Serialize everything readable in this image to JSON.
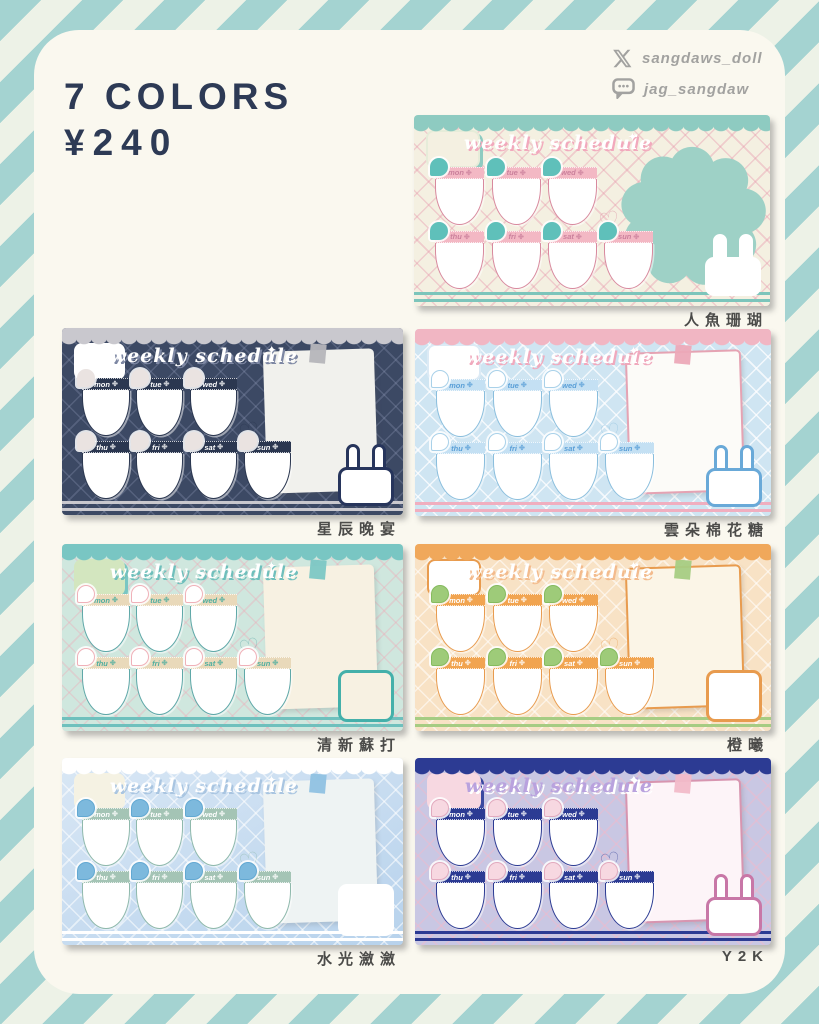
{
  "page": {
    "title": "7 COLORS",
    "price": "¥240",
    "socials": [
      {
        "icon": "x-icon",
        "handle": "sangdaws_doll"
      },
      {
        "icon": "chat-bubble-icon",
        "handle": "jag_sangdaw"
      }
    ],
    "colors": {
      "stripe_teal": "#a4d3d1",
      "stripe_cream": "#edf2e7",
      "panel_bg": "#faf8ef",
      "title_color": "#2d3a55",
      "social_color": "#a2a2a0",
      "label_color": "#4b4b49"
    }
  },
  "card_common": {
    "title": "weekly schedule",
    "days_row1": [
      "mon",
      "tue",
      "wed"
    ],
    "days_row2": [
      "thu",
      "fri",
      "sat",
      "sun"
    ],
    "clover_icon": "✤",
    "sparkle_icon": "✦",
    "heart_icon": "♡"
  },
  "cards": [
    {
      "label": "人魚珊瑚",
      "right_variant": "blob",
      "corner_variant": "bunny",
      "vars": {
        "--bg": "#f4f0e1",
        "--lattice": "rgba(231,151,172,0.40)",
        "--scallop": "#8ecbc1",
        "--title": "#ffffff",
        "--title-shadow": "#f2a9bd",
        "--head-bg": "#f3b8c4",
        "--head-text": "#cb809c",
        "--drop": "#5fc0ba",
        "--drop-border": "#5fc0ba",
        "--pocket-border": "#d8899e",
        "--paper-bg": "#f4f0e1",
        "--paper-border": "#f4f0e1",
        "--tape": "#8ecbc1",
        "--blob": "#9ed1c6",
        "--corner-bg": "#ffffff",
        "--corner-border": "#ffffff",
        "--stripe": "#7cc5bb",
        "--note-bg": "#f4f0e1",
        "--note-border": "#e6ecd9",
        "--note-shadow": "#8ecbc1"
      }
    },
    {
      "label": "星辰晚宴",
      "right_variant": "paper",
      "corner_variant": "bunny",
      "vars": {
        "--bg": "#3c4964",
        "--lattice": "rgba(150,160,190,0.28)",
        "--scallop": "#c9c8ce",
        "--title": "#ffffff",
        "--title-shadow": "#7d87a3",
        "--head-bg": "#2b3750",
        "--head-text": "#ffffff",
        "--drop": "#eae3e1",
        "--drop-border": "#eae3e1",
        "--pocket-border": "#2b3750",
        "--paper-bg": "#f1f1ed",
        "--paper-border": "#f1f1ed",
        "--tape": "#b5b5ba",
        "--blob": "#c9c8ce",
        "--corner-bg": "#ffffff",
        "--corner-border": "#27355c",
        "--stripe": "#c9c8ce",
        "--note-bg": "#ffffff",
        "--note-border": "#ffffff",
        "--note-shadow": "rgba(0,0,0,0)"
      }
    },
    {
      "label": "雲朵棉花糖",
      "right_variant": "paper",
      "corner_variant": "bunny",
      "vars": {
        "--bg": "#cfe5f2",
        "--lattice": "rgba(255,255,255,0.75)",
        "--scallop": "#f1b6c3",
        "--title": "#ffffff",
        "--title-shadow": "#f0a9bd",
        "--head-bg": "#c4e0f3",
        "--head-text": "#5a9fd7",
        "--drop": "#ffffff",
        "--drop-border": "#a9d1e9",
        "--pocket-border": "#8abedd",
        "--paper-bg": "#fcfbf8",
        "--paper-border": "#e5a3b3",
        "--tape": "#eca9b8",
        "--blob": "#f1b6c3",
        "--corner-bg": "#ffffff",
        "--corner-border": "#69a9d8",
        "--stripe": "#f0aebf",
        "--note-bg": "#ffffff",
        "--note-border": "#dceaf5",
        "--note-shadow": "rgba(0,0,0,0)"
      }
    },
    {
      "label": "清新蘇打",
      "right_variant": "paper",
      "corner_variant": "square",
      "vars": {
        "--bg": "#cfe7de",
        "--lattice": "rgba(240,165,180,0.35)",
        "--scallop": "#79c6c3",
        "--title": "#ffffff",
        "--title-shadow": "#6fbfbc",
        "--head-bg": "#e9d9ba",
        "--head-text": "#4fae9f",
        "--drop": "#ffffff",
        "--drop-border": "#f0b1b9",
        "--pocket-border": "#5fa8a8",
        "--paper-bg": "#f7f1e2",
        "--paper-border": "#f7f1e2",
        "--tape": "#7cc7c4",
        "--blob": "#79c6c3",
        "--corner-bg": "#f7f1e2",
        "--corner-border": "#44b0aa",
        "--stripe": "#6fc0bd",
        "--note-bg": "#d3e6bf",
        "--note-border": "#d3e6bf",
        "--note-shadow": "#79c6c3"
      }
    },
    {
      "label": "橙曦",
      "right_variant": "paper",
      "corner_variant": "square",
      "vars": {
        "--bg": "#f8e2c5",
        "--lattice": "rgba(255,255,255,0.55)",
        "--scallop": "#f0a85b",
        "--title": "#ffffff",
        "--title-shadow": "#f3bb8d",
        "--head-bg": "#f1a450",
        "--head-text": "#ffffff",
        "--drop": "#9ecb79",
        "--drop-border": "#85bb5e",
        "--pocket-border": "#e89b4e",
        "--paper-bg": "#fbf5e7",
        "--paper-border": "#e89b4e",
        "--tape": "#a6cc83",
        "--blob": "#f0a85b",
        "--corner-bg": "#ffffff",
        "--corner-border": "#e89b4e",
        "--stripe": "#a6cc83",
        "--note-bg": "#ffffff",
        "--note-border": "#e89b4e",
        "--note-shadow": "rgba(0,0,0,0)"
      }
    },
    {
      "label": "水光瀲瀲",
      "right_variant": "paper",
      "corner_variant": "square",
      "vars": {
        "--bg": "#d9e7f5",
        "--bg2": "#b7d2ec",
        "--lattice": "rgba(255,255,255,0.55)",
        "--scallop": "#ffffff",
        "--title": "#ffffff",
        "--title-shadow": "#a9c5e1",
        "--head-bg": "#a4c4b5",
        "--head-text": "#ffffff",
        "--drop": "#7db9dd",
        "--drop-border": "#62a8d2",
        "--pocket-border": "#8fb9ac",
        "--paper-bg": "#eef3f3",
        "--paper-border": "#eef3f3",
        "--tape": "#8fc1e1",
        "--blob": "#ffffff",
        "--corner-bg": "#ffffff",
        "--corner-border": "#ffffff",
        "--stripe": "#ffffff",
        "--note-bg": "#f5f2e3",
        "--note-border": "#f5f2e3",
        "--note-shadow": "rgba(0,0,0,0)"
      }
    },
    {
      "label": "Y2K",
      "right_variant": "paper",
      "corner_variant": "bunny",
      "vars": {
        "--bg": "#c9c7e3",
        "--lattice": "rgba(244,183,200,0.45)",
        "--scallop": "#2c3b93",
        "--title": "#b9a2de",
        "--title-shadow": "#ffffff",
        "--head-bg": "#2c3b93",
        "--head-text": "#ffffff",
        "--drop": "#f7d8e1",
        "--drop-border": "#e2aabe",
        "--pocket-border": "#2c3b93",
        "--paper-bg": "#fdf4f8",
        "--paper-border": "#d795b0",
        "--tape": "#f2bac9",
        "--blob": "#2c3b93",
        "--corner-bg": "#ffffff",
        "--corner-border": "#c877a7",
        "--stripe": "#2c3b93",
        "--note-bg": "#f7d8e1",
        "--note-border": "#f7d8e1",
        "--note-shadow": "#3a49a0"
      }
    }
  ]
}
